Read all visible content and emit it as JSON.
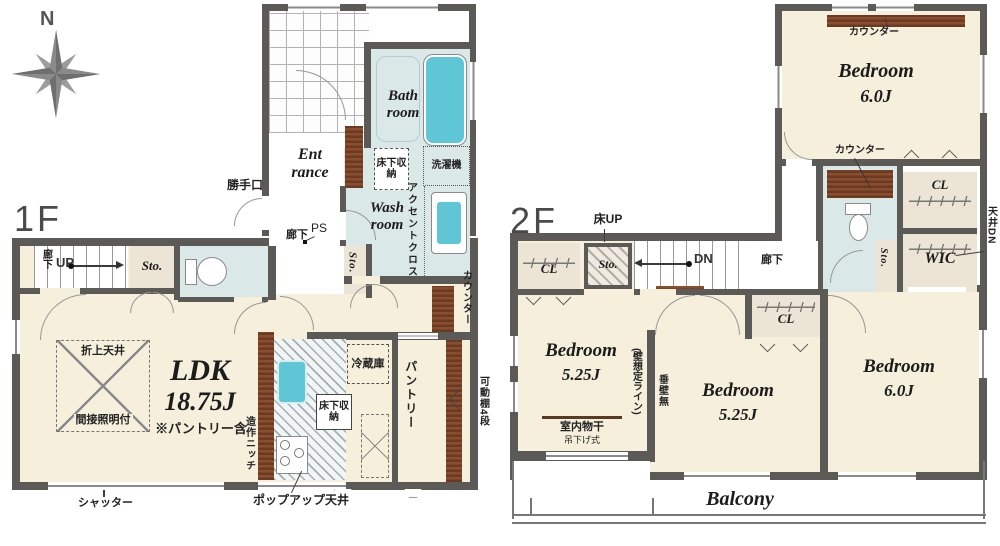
{
  "compass": {
    "n": "N"
  },
  "f1": {
    "label": "1F",
    "entrance1": "Ent",
    "entrance2": "rance",
    "bath1": "Bath",
    "bath2": "room",
    "wash1": "Wash",
    "wash2": "room",
    "underfloor": "床下収納",
    "washer": "洗濯機",
    "accent": "アクセントクロス",
    "backdoor": "勝手口",
    "corridor": "廊下",
    "ps": "PS",
    "sto": "Sto.",
    "up": "UP",
    "ldk": "LDK",
    "ldk_size": "18.75J",
    "ldk_note": "※パントリー含",
    "coffered": "折上天井",
    "indirect": "間接照明付",
    "fridge": "冷蔵庫",
    "niche": "造作ニッチ",
    "pantry": "パントリー",
    "shelf": "可動棚4段",
    "shutter": "シャッター",
    "popup": "ポップアップ天井",
    "counter": "カウンター"
  },
  "f2": {
    "label": "2F",
    "bedroom": "Bedroom",
    "size_6": "6.0J",
    "size_525": "5.25J",
    "counter": "カウンター",
    "cl": "CL",
    "wic": "WIC",
    "ceiling_dn": "天井DN",
    "sto": "Sto.",
    "floor_up": "床UP",
    "dn": "DN",
    "corridor": "廊下",
    "drying": "室内物干",
    "hanging": "吊下げ式",
    "wall_line": "(壁想定ライン)",
    "no_wall": "垂壁無",
    "balcony": "Balcony"
  }
}
